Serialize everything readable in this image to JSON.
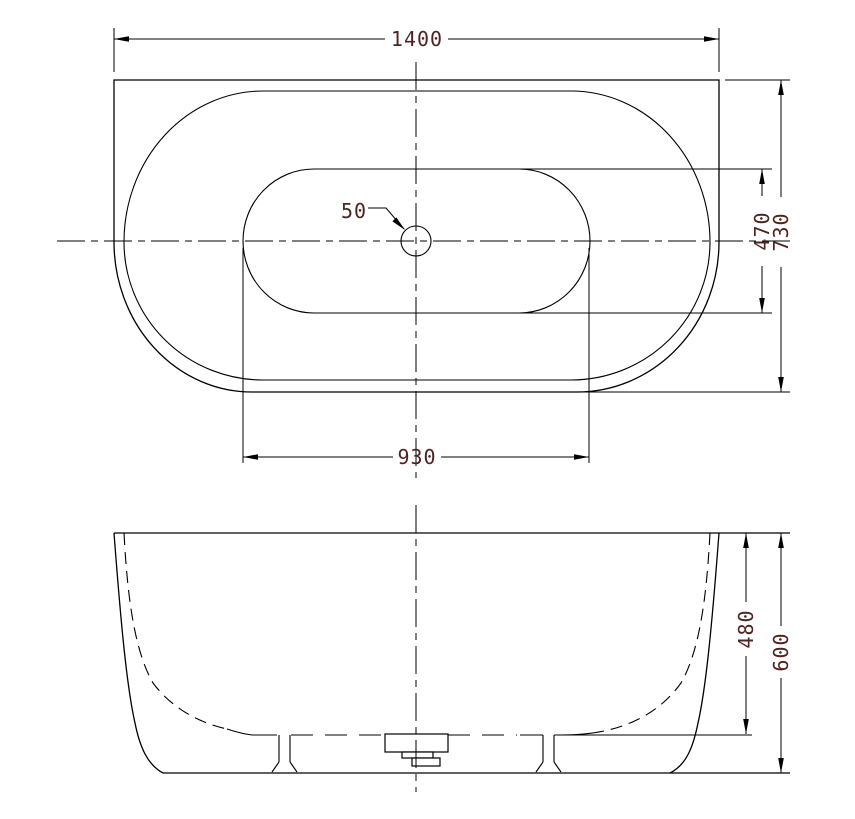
{
  "colors": {
    "line": "#000000",
    "dim_text": "#4f2420",
    "background": "#ffffff"
  },
  "top_view": {
    "dim_overall_width": "1400",
    "dim_overall_depth": "730",
    "dim_basin_length": "930",
    "dim_basin_width": "470",
    "dim_drain": "50"
  },
  "front_view": {
    "dim_inner_depth": "480",
    "dim_overall_height": "600"
  }
}
